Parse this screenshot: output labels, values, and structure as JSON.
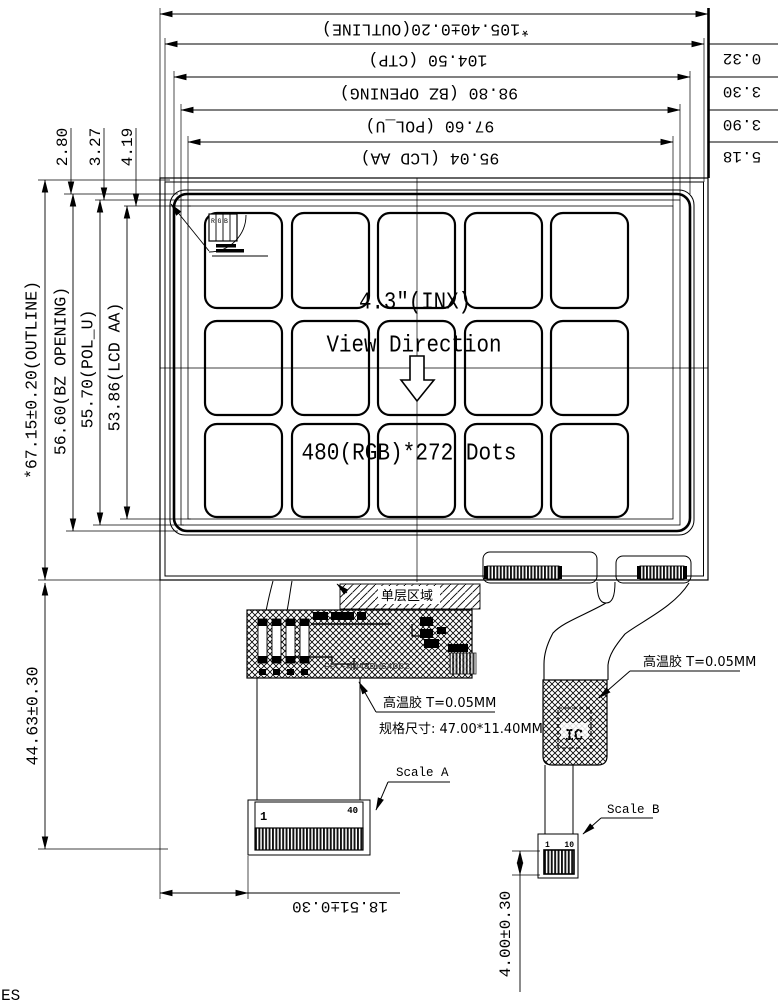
{
  "dims": {
    "top": [
      "*105.40±0.20(OUTLINE)",
      "104.50 (CTP)",
      "98.80 (BZ OPENING)",
      "97.60 (POL_U)",
      "95.04 (LCD AA)"
    ],
    "right_edge": [
      "0.32",
      "3.30",
      "3.90",
      "5.18"
    ],
    "top_left": [
      "2.80",
      "3.27",
      "4.19"
    ],
    "left": [
      "*67.15±0.20(OUTLINE)",
      "56.60(BZ OPENING)",
      "55.70(POL_U)",
      "53.86(LCD AA)"
    ],
    "fpc_length": "44.63±0.30",
    "conn_a_offset": "18.51±0.30",
    "conn_b_tail": "4.00±0.30"
  },
  "display": {
    "size": "4.3\"(INX)",
    "view_direction": "View Direction",
    "resolution": "480(RGB)*272 Dots",
    "pixel_label": "RGB"
  },
  "fpc": {
    "single_layer": "单层区域",
    "tape_left": "高温胶 T=0.05MM",
    "tape_right": "高温胶 T=0.05MM",
    "spec": "规格尺寸: 47.00*11.40MM",
    "part_no": "FPC-H043DWG4062",
    "ic": "IC",
    "scale_a": "Scale A",
    "scale_b": "Scale B",
    "conn_a_first_pin": "1",
    "conn_a_last_pin": "40",
    "conn_b_first_pin": "1",
    "conn_b_last_pin": "10"
  },
  "corner_note": "ES"
}
